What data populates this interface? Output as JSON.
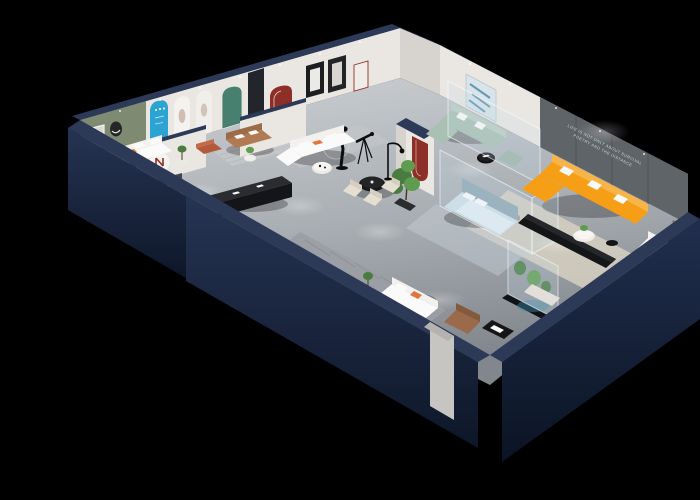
{
  "scene": {
    "title": "3D isometric cutaway render of a furniture showroom floor plan",
    "background": "black",
    "slogan_line1": "LIFE IS NOT ONLY ABOUT SURVIVAL",
    "slogan_line2": "POETRY AND THE DISTANCE",
    "style": "spot-lit rooms, navy cutaway walls, light gray floors"
  },
  "palette": {
    "bg": "#000000",
    "navy_top": "#2c3a58",
    "navy_face": "#1b2742",
    "navy_dark": "#121c31",
    "wall_white": "#eae7e2",
    "wall_shade": "#d7d3ce",
    "floor_light": "#cdd1d4",
    "floor_mid": "#a9aeb3",
    "floor_dark": "#82878d",
    "accent_green_wall": "#7e8a72",
    "accent_teal_door": "#47806e",
    "accent_blue_poster": "#2ba4d3",
    "accent_red": "#8e2f27",
    "sofa_orange": "#f59e16",
    "sofa_orange_light": "#f8b445",
    "sofa_tan": "#b07a52",
    "sofa_sage": "#a9c0b2",
    "bed_blue": "#cfe0ea",
    "plant_green": "#4a7c42",
    "furn_black": "#141517",
    "rug_cream": "#d9d2c2",
    "panel_gray": "#5f6468",
    "glass_tint": "rgba(195,220,232,0.22)"
  },
  "rooms": [
    "green accent lounge",
    "arch poster gallery",
    "tan loveseat lounge",
    "white sectional living room",
    "dining display",
    "front bedroom display",
    "sage sofa lounge",
    "glass bedroom display",
    "orange sectional living room",
    "entry seating area"
  ],
  "objects": [
    "white lounge sofa with orange cushions",
    "rust ottoman",
    "tan loveseat",
    "blue arch poster with glyphs",
    "white arch posters",
    "teal arched door",
    "red arch niche",
    "black framed artwork",
    "circular poster with red mark",
    "bed with tan throw",
    "black media credenza",
    "white sectional sofa",
    "black round dining table with cream chairs",
    "black floor lamp",
    "mannequin sculpture with ring",
    "telescope",
    "large potted plant",
    "white column with red arch logo",
    "sage green sofa set",
    "black round coffee table",
    "glass partitions",
    "blue abstract artwork",
    "dark feature wall with slogan",
    "orange sectional sofa with white pillows",
    "black media bench",
    "round white coffee table",
    "white armchair",
    "teddy bear figure",
    "glass plant terrarium",
    "blue bed in glass room",
    "white entry sofa",
    "brown leather armchair",
    "black magazine table",
    "entrance doorway"
  ]
}
